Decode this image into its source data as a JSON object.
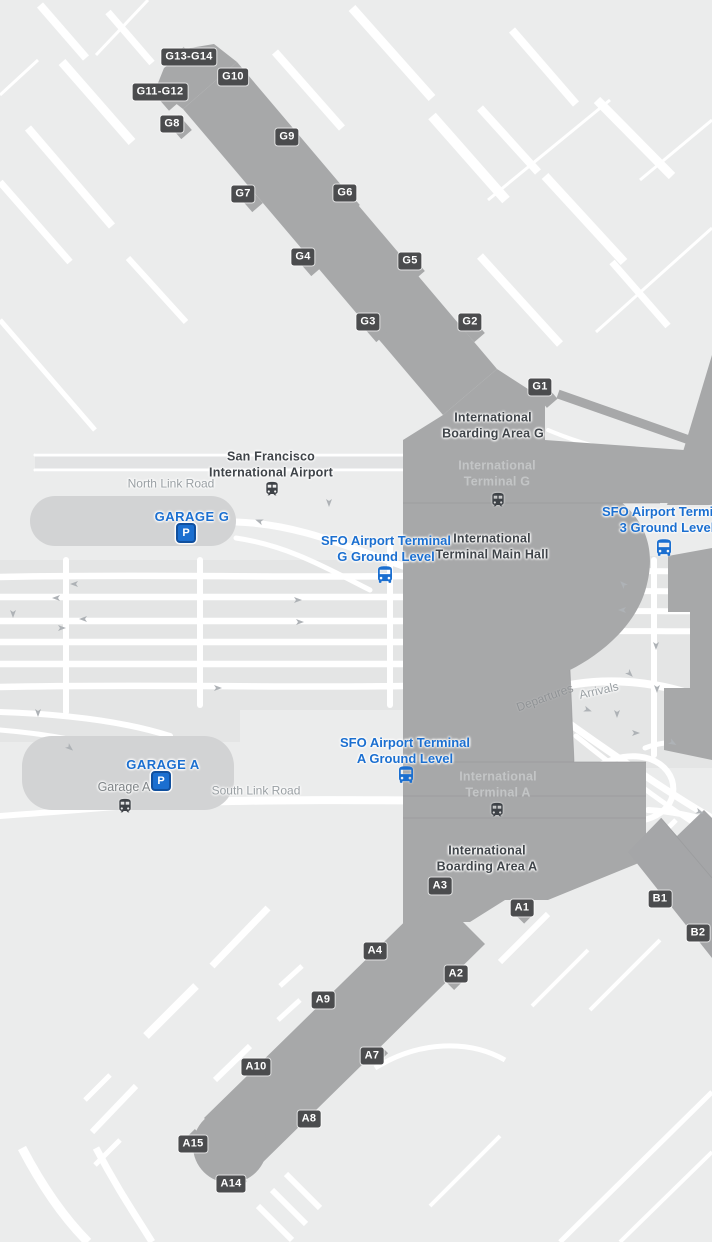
{
  "map_name": "San Francisco International Airport terminal map",
  "colors": {
    "background": "#ebecec",
    "road_white": "#ffffff",
    "corridor": "#e4e5e5",
    "building": "#a7a8a9",
    "building_line": "#97989a",
    "garage": "#d2d3d4",
    "badge_bg": "#4b4c4e",
    "badge_text": "#ffffff",
    "poi_blue": "#1b6fd0",
    "parking_border": "#11509e",
    "label_dark": "#3f4449",
    "label_light": "#c3c5c6",
    "label_road": "#9aa0a4",
    "icon_dark": "#3e4247",
    "arrow": "#aeb2b6"
  },
  "gate_badges": [
    {
      "id": "G13-G14",
      "x": 189,
      "y": 57
    },
    {
      "id": "G10",
      "x": 233,
      "y": 77
    },
    {
      "id": "G11-G12",
      "x": 160,
      "y": 92
    },
    {
      "id": "G8",
      "x": 172,
      "y": 124
    },
    {
      "id": "G9",
      "x": 287,
      "y": 137
    },
    {
      "id": "G7",
      "x": 243,
      "y": 194
    },
    {
      "id": "G6",
      "x": 345,
      "y": 193
    },
    {
      "id": "G4",
      "x": 303,
      "y": 257
    },
    {
      "id": "G5",
      "x": 410,
      "y": 261
    },
    {
      "id": "G3",
      "x": 368,
      "y": 322
    },
    {
      "id": "G2",
      "x": 470,
      "y": 322
    },
    {
      "id": "G1",
      "x": 540,
      "y": 387
    },
    {
      "id": "A3",
      "x": 440,
      "y": 886
    },
    {
      "id": "A1",
      "x": 522,
      "y": 908
    },
    {
      "id": "B1",
      "x": 660,
      "y": 899
    },
    {
      "id": "B2",
      "x": 698,
      "y": 933
    },
    {
      "id": "A4",
      "x": 375,
      "y": 951
    },
    {
      "id": "A2",
      "x": 456,
      "y": 974
    },
    {
      "id": "A9",
      "x": 323,
      "y": 1000
    },
    {
      "id": "A7",
      "x": 372,
      "y": 1056
    },
    {
      "id": "A10",
      "x": 256,
      "y": 1067
    },
    {
      "id": "A8",
      "x": 309,
      "y": 1119
    },
    {
      "id": "A15",
      "x": 193,
      "y": 1144
    },
    {
      "id": "A14",
      "x": 231,
      "y": 1184
    }
  ],
  "labels": [
    {
      "name": "airport-name-label",
      "lines": [
        "San Francisco",
        "International Airport"
      ],
      "x": 271,
      "y": 465,
      "style": "place-dark",
      "interactable": false
    },
    {
      "name": "north-link-road-label",
      "lines": [
        "North Link Road"
      ],
      "x": 171,
      "y": 484,
      "style": "road",
      "interactable": false
    },
    {
      "name": "garage-g-label",
      "lines": [
        "GARAGE G"
      ],
      "x": 192,
      "y": 517,
      "style": "poi-blue-caps",
      "interactable": true
    },
    {
      "name": "boarding-area-g-label",
      "lines": [
        "International",
        "Boarding Area G"
      ],
      "x": 493,
      "y": 426,
      "style": "place-dark",
      "interactable": false
    },
    {
      "name": "terminal-g-label",
      "lines": [
        "International",
        "Terminal G"
      ],
      "x": 497,
      "y": 474,
      "style": "place-light",
      "interactable": false
    },
    {
      "name": "terminal-g-shuttle-label",
      "lines": [
        "SFO Airport Terminal",
        "G Ground Level"
      ],
      "x": 386,
      "y": 549,
      "style": "poi-blue",
      "interactable": true
    },
    {
      "name": "terminal-main-hall-label",
      "lines": [
        "International",
        "Terminal Main Hall"
      ],
      "x": 492,
      "y": 547,
      "style": "place-dark",
      "interactable": false
    },
    {
      "name": "terminal-3-shuttle-label",
      "lines": [
        "SFO Airport Terminal",
        "3 Ground Level"
      ],
      "x": 667,
      "y": 520,
      "style": "poi-blue",
      "interactable": true
    },
    {
      "name": "departures-label",
      "lines": [
        "Departures"
      ],
      "x": 545,
      "y": 698,
      "style": "road-on-building",
      "rotate": -20,
      "interactable": false
    },
    {
      "name": "arrivals-label",
      "lines": [
        "Arrivals"
      ],
      "x": 599,
      "y": 691,
      "style": "road",
      "rotate": -13,
      "interactable": false
    },
    {
      "name": "garage-a-label",
      "lines": [
        "GARAGE A"
      ],
      "x": 163,
      "y": 765,
      "style": "poi-blue-caps",
      "interactable": true
    },
    {
      "name": "garage-a-station-label",
      "lines": [
        "Garage A"
      ],
      "x": 124,
      "y": 788,
      "style": "place-gray",
      "interactable": false
    },
    {
      "name": "south-link-road-label",
      "lines": [
        "South Link Road"
      ],
      "x": 256,
      "y": 791,
      "style": "road",
      "interactable": false
    },
    {
      "name": "terminal-a-shuttle-label",
      "lines": [
        "SFO Airport Terminal",
        "A Ground Level"
      ],
      "x": 405,
      "y": 751,
      "style": "poi-blue",
      "interactable": true
    },
    {
      "name": "terminal-a-label",
      "lines": [
        "International",
        "Terminal A"
      ],
      "x": 498,
      "y": 785,
      "style": "place-light",
      "interactable": false
    },
    {
      "name": "boarding-area-a-label",
      "lines": [
        "International",
        "Boarding Area A"
      ],
      "x": 487,
      "y": 859,
      "style": "place-dark",
      "interactable": false
    }
  ],
  "transit_icons": [
    {
      "name": "airtrain-station-icon",
      "type": "train",
      "x": 272,
      "y": 489
    },
    {
      "name": "airtrain-station-icon",
      "type": "train",
      "x": 498,
      "y": 500
    },
    {
      "name": "airtrain-station-icon",
      "type": "train",
      "x": 125,
      "y": 806
    },
    {
      "name": "airtrain-station-icon",
      "type": "train",
      "x": 497,
      "y": 810
    },
    {
      "name": "shuttle-bus-stop-icon",
      "type": "bus",
      "x": 385,
      "y": 575
    },
    {
      "name": "shuttle-bus-stop-icon",
      "type": "bus",
      "x": 664,
      "y": 548
    },
    {
      "name": "shuttle-bus-stop-icon",
      "type": "bus",
      "x": 406,
      "y": 775
    },
    {
      "name": "parking-icon",
      "type": "parking",
      "glyph": "P",
      "x": 186,
      "y": 533
    },
    {
      "name": "parking-icon",
      "type": "parking",
      "glyph": "P",
      "x": 161,
      "y": 781
    }
  ]
}
